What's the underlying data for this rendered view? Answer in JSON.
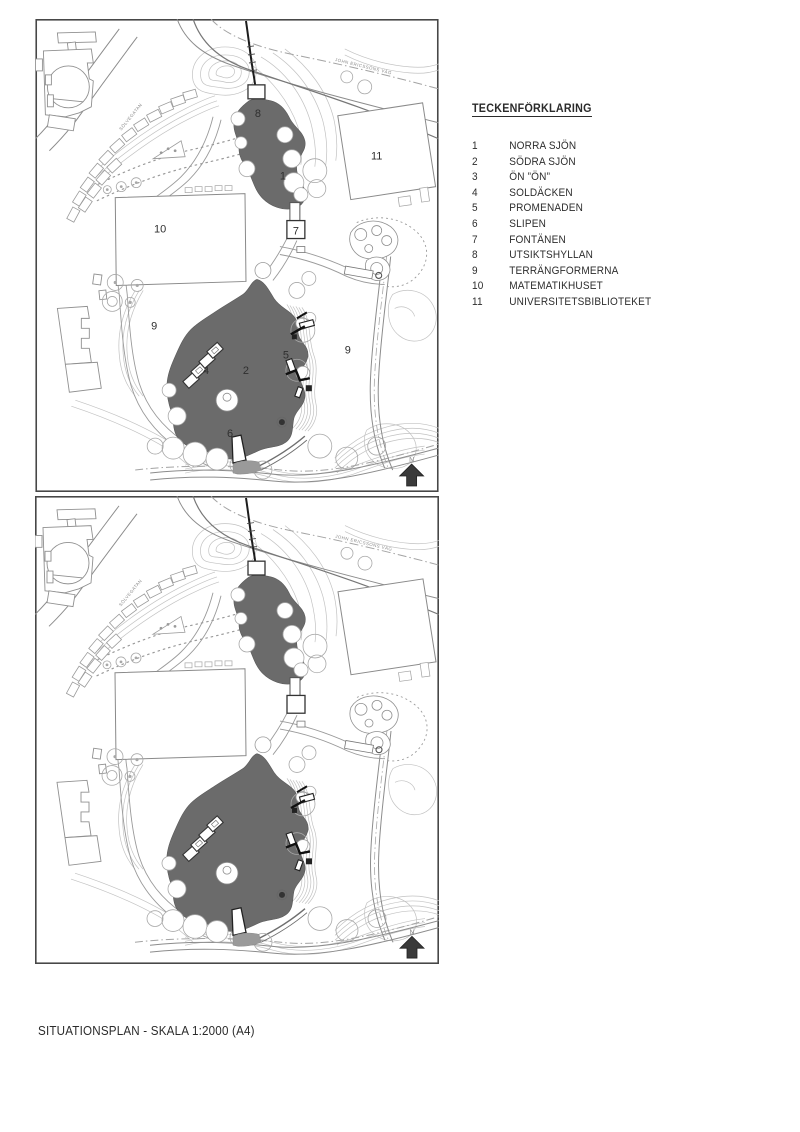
{
  "page": {
    "caption": "SITUATIONSPLAN - SKALA 1:2000 (A4)"
  },
  "legend": {
    "title": "TECKENFÖRKLARING",
    "items": [
      {
        "num": "1",
        "label": "NORRA SJÖN"
      },
      {
        "num": "2",
        "label": "SÖDRA SJÖN"
      },
      {
        "num": "3",
        "label": "ÖN ”ÖN”"
      },
      {
        "num": "4",
        "label": "SOLDÄCKEN"
      },
      {
        "num": "5",
        "label": "PROMENADEN"
      },
      {
        "num": "6",
        "label": "SLIPEN"
      },
      {
        "num": "7",
        "label": "FONTÄNEN"
      },
      {
        "num": "8",
        "label": "UTSIKTSHYLLAN"
      },
      {
        "num": "9",
        "label": "TERRÄNGFORMERNA"
      },
      {
        "num": "10",
        "label": "MATEMATIKHUSET"
      },
      {
        "num": "11",
        "label": "UNIVERSITETSBIBLIOTEKET"
      }
    ]
  },
  "map": {
    "street_labels": {
      "john_ericssons_vag": "JOHN ERICSSONS VÄG",
      "solvegatan": "SÖLVEGATAN"
    },
    "north_label": "N",
    "labels": {
      "norra_sjon": "1",
      "sodra_sjon": "2",
      "soldacken": "4",
      "promenaden": "5",
      "slipen": "6",
      "fontanen": "7",
      "utsiktshyllan": "8",
      "terrang_west": "9",
      "terrang_east": "9",
      "matematikhuset": "10",
      "universitetsbiblioteket": "11"
    },
    "colors": {
      "water": "#6b6b6b",
      "contour": "#bdbdbd",
      "linework": "#8c8c8c",
      "dark": "#222222"
    }
  }
}
